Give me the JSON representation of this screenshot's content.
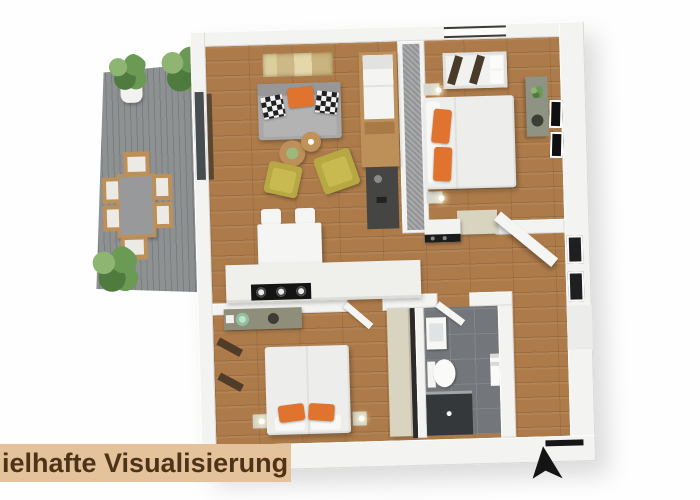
{
  "banner": {
    "label": "ielhafte Visualisierung"
  },
  "compass": {
    "type": "north-arrow",
    "points": "up"
  },
  "scene": {
    "type": "3d-floor-plan-rendering",
    "rooms": [
      {
        "name": "terrace",
        "floor": "gray-wood-deck",
        "items": [
          "outdoor-dining-table",
          "outdoor-chairs-6",
          "potted-plants-3"
        ]
      },
      {
        "name": "living-dining-kitchen",
        "floor": "wood",
        "items": [
          "sofa",
          "checkered-pillows",
          "orange-throw",
          "wall-art",
          "coffee-tables-2",
          "armchairs-2",
          "dining-table",
          "dining-chairs-4",
          "kitchen-counter",
          "cooktop",
          "kitchen-tall-unit",
          "terrace-sliding-door"
        ]
      },
      {
        "name": "bedroom-top-right",
        "floor": "wood",
        "items": [
          "double-bed",
          "orange-pillows",
          "open-wardrobe",
          "dresser",
          "plant",
          "picture-frames",
          "nightstand-lamps"
        ]
      },
      {
        "name": "bedroom-bottom-left",
        "floor": "wood",
        "items": [
          "double-bed",
          "orange-pillows",
          "sideboard",
          "wall-shelves",
          "wardrobe",
          "nightstand-lamps"
        ]
      },
      {
        "name": "bathroom",
        "floor": "gray-tile",
        "items": [
          "washbasin",
          "toilet",
          "shower",
          "towel-radiator",
          "door"
        ]
      },
      {
        "name": "hallway",
        "floor": "wood",
        "items": [
          "entrance-door",
          "washing-machine",
          "closet-doors",
          "windows-2"
        ]
      }
    ]
  },
  "colors": {
    "banner_bg": "#e3c29c",
    "banner_text": "#4e3317",
    "wall": "#f3f3f1",
    "wood_floor": "#ad7b4a",
    "deck": "#8e9192",
    "deck_line": "#7b7e80",
    "tile_floor": "#73767a",
    "sofa_gray": "#a8a8a8",
    "accent_orange": "#e0742f",
    "armchair_olive": "#b7a843",
    "plant_green": "#6b9a55",
    "plant_green_light": "#8fb573",
    "plant_green_dark": "#4f7c3e",
    "counter_white": "#efefec",
    "cabinet_green_gray": "#8e8e7b",
    "wood_furniture": "#bd9059",
    "dark_fixture": "#34383a",
    "window_dark": "#1e1f20",
    "wardrobe_beige": "#d9d4bf",
    "north_arrow": "#141414"
  }
}
